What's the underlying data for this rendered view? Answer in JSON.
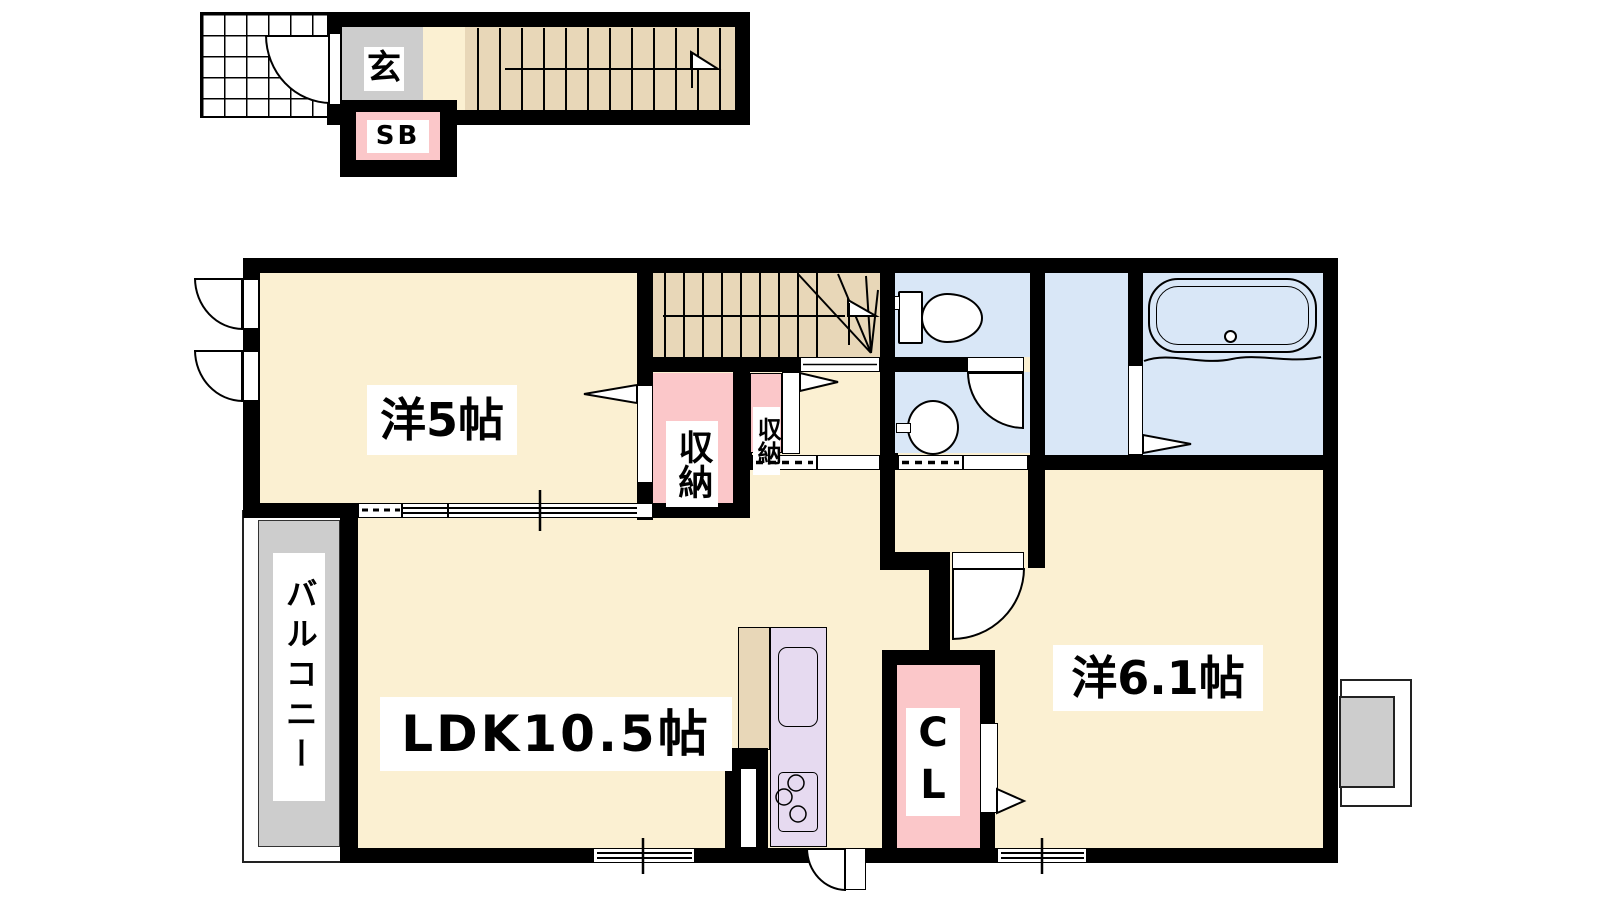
{
  "labels": {
    "entrance": "玄",
    "shoe_box": "SB",
    "storage_large": "収納",
    "storage_small": "収納",
    "western_5": "洋5帖",
    "ldk": "LDK10.5帖",
    "western_6_1": "洋6.1帖",
    "closet": "CL",
    "balcony": "バルコニー"
  },
  "colors": {
    "wall": "#000000",
    "room_cream": "#fbf0d2",
    "stairs_tan": "#e8d7b8",
    "water_blue": "#d9e7f7",
    "storage_pink": "#fbc7c9",
    "kitchen_lavender": "#e6daf0",
    "gray_zone": "#cdcdcd"
  }
}
